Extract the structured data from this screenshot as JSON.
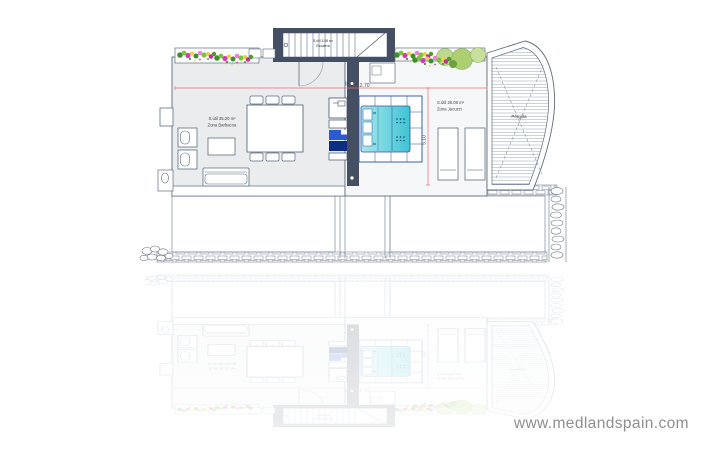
{
  "watermark": {
    "text": "www.medlandspain.com",
    "color": "#8f8f8f"
  },
  "plan": {
    "labels": {
      "stairs_area": "S.útil 3.08 m²",
      "stairs_name": "Escalera",
      "barbecue_area": "S.útil 35.20 m²",
      "barbecue_name": "Zona Barbacoa",
      "jacuzzi_area": "S.útil 26.08 m²",
      "jacuzzi_name": "Zona Jacuzzi",
      "pergola": "Pérgola"
    },
    "dimensions": {
      "horizontal": "12.70",
      "vertical": "5.10"
    },
    "colors": {
      "wall_dark": "#454f63",
      "outline": "#5d6e80",
      "dimension_red": "#e57373",
      "pool_light": "#a9e9ec",
      "pool_dark": "#3fc3d4",
      "pool_edge": "#24549e",
      "cabinet_blue": "#2b5ccc",
      "cabinet_navy": "#0b2d85",
      "bush_green": "#bed98f",
      "flower_pink": "#d23cb4",
      "flower_yellow": "#e8d23f",
      "leaf_green": "#3d8f2d"
    }
  }
}
